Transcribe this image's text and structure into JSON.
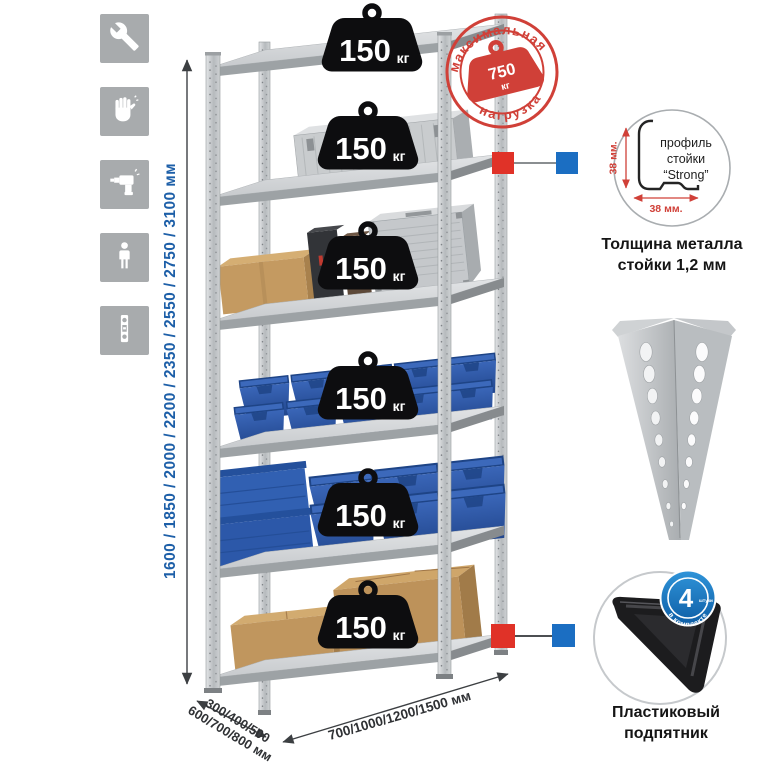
{
  "colors": {
    "accent_red": "#e03228",
    "accent_blue": "#1b6ec2",
    "stamp_red": "#d04038",
    "dimension_blue": "#1d5fa8",
    "bin_blue": "#2c58a9",
    "cardboard": "#c49a61",
    "icon_tile_gray": "#a8abad"
  },
  "assembly_icons": [
    {
      "name": "wrench-icon"
    },
    {
      "name": "gloves-icon"
    },
    {
      "name": "drill-icon"
    },
    {
      "name": "person-icon"
    },
    {
      "name": "level-icon"
    }
  ],
  "height_dimension": {
    "label": "1600 / 1850 / 2000 / 2200 / 2350 / 2550 / 2750 / 3100 мм"
  },
  "rack": {
    "badges": [
      {
        "value": "150",
        "unit": "кг"
      },
      {
        "value": "150",
        "unit": "кг"
      },
      {
        "value": "150",
        "unit": "кг"
      },
      {
        "value": "150",
        "unit": "кг"
      },
      {
        "value": "150",
        "unit": "кг"
      },
      {
        "value": "150",
        "unit": "кг"
      }
    ]
  },
  "max_load_stamp": {
    "arc_top": "максимальная",
    "arc_bottom": "нагрузка",
    "value": "750",
    "unit": "кг"
  },
  "profile_detail": {
    "line1": "профиль",
    "line2": "стойки",
    "line3": "“Strong”",
    "dim_vertical": "38 мм.",
    "dim_horizontal": "38 мм.",
    "caption_line1": "Толщина металла",
    "caption_line2": "стойки 1,2 мм"
  },
  "foot_detail": {
    "badge_value": "4",
    "badge_small": "штуки",
    "badge_arc": "в комплекте",
    "caption_line1": "Пластиковый",
    "caption_line2": "подпятник"
  },
  "depth_dimension": {
    "line1": "300/400/500",
    "line2": "600/700/800 мм"
  },
  "width_dimension": {
    "label": "700/1000/1200/1500 мм"
  }
}
